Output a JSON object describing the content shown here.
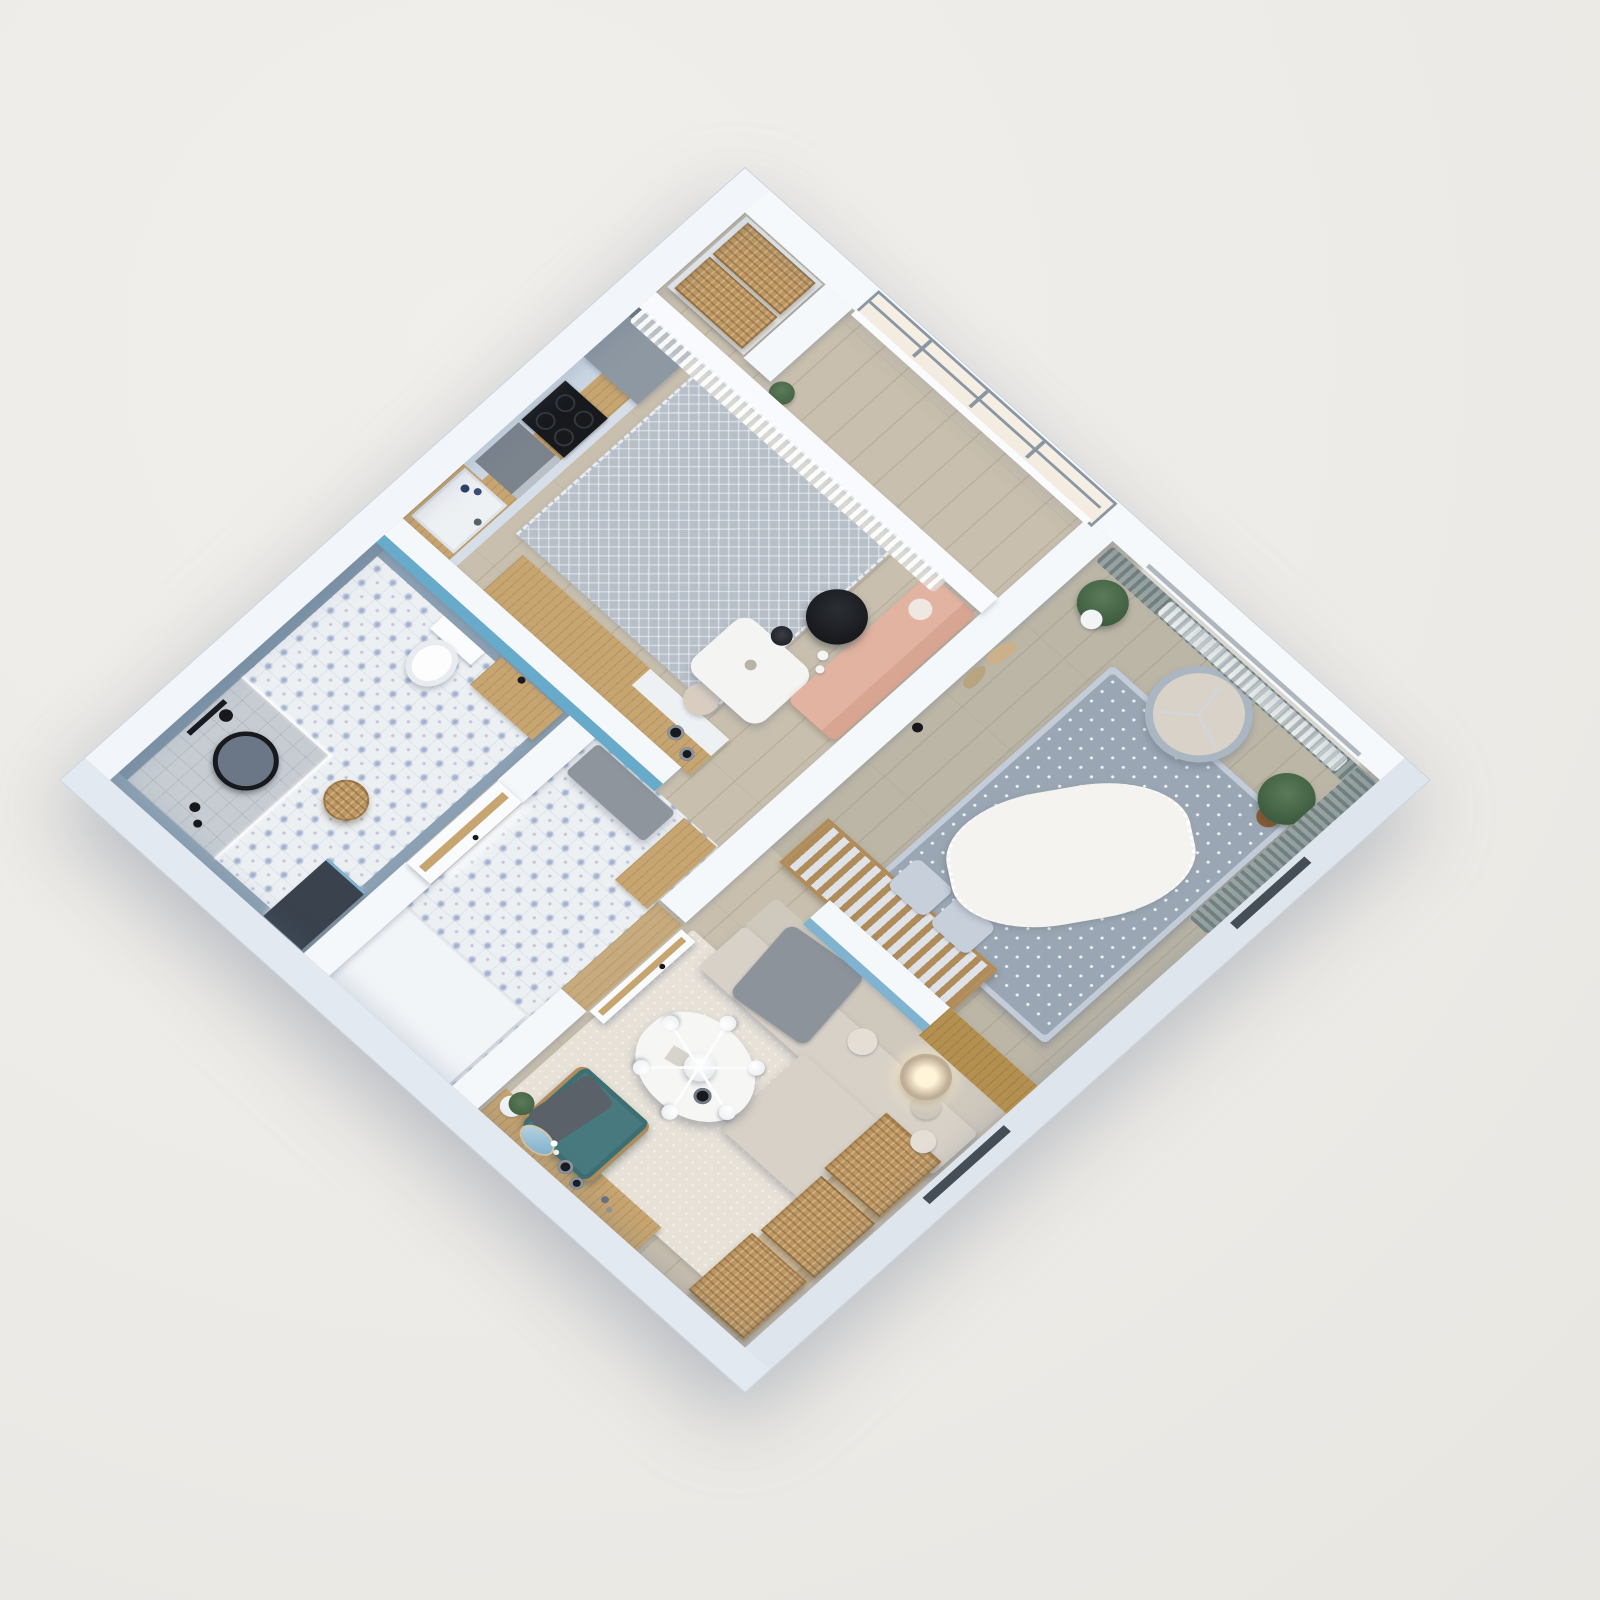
{
  "scene": {
    "type": "3d-isometric-floorplan-render",
    "label": "3D cutaway floor plan of a one-bedroom apartment",
    "view": "top-down isometric, plan rotated 45 degrees on a warm light-gray backdrop"
  },
  "palette": {
    "bg": "#edebe7",
    "wall": "#f5f8fb",
    "wallTop": "#f8fafd",
    "wallShade": "#dee5ed",
    "wallEdge": "#c9d1da",
    "wood": "#c7a571",
    "woodFloor": "#c8bfae",
    "bedroomTint": "rgba(120,125,125,.14)",
    "tileBase": "#edf0f3",
    "tileBlue": "#5d7ab0",
    "accentBlue": "#68aac9",
    "accentBlueSoft": "#7fb3cf",
    "teal": "#47797e",
    "tealDark": "#3d6e72",
    "peach": "#e2b3a1",
    "peachDark": "#d8a592",
    "sofaBeige": "#d8d1c7",
    "sofaBeigeDark": "#cfc8bd",
    "bedding": "#9aa6b3",
    "bedFrame": "#c2cdd9",
    "pillow": "#c6cfda",
    "blanket": "#f4f3f0",
    "curtain": "#98a5a4",
    "curtainDark": "#75817e",
    "wicker": "#bd9662",
    "rugKitchen": "#b7bfc9",
    "rugLiving": "#e7e1d7",
    "black": "#17191d",
    "glass": "#f3ebdf",
    "frame": "#8b96a3",
    "fridge": "#8e98a3",
    "oven": "#7b838d",
    "grayThrow": "#8d939b",
    "benchGray": "#8f959d",
    "shower": "#c6ccd2",
    "bathWall": "#8ba1b3",
    "mirrorDark": "#39424d",
    "potBrown": "#8a5a33",
    "plant": "#3d5c3f",
    "plantLight": "#5a7a58",
    "lampShade": "#bfae97",
    "glow": "#fff3d8",
    "cribWood": "#b08c5a",
    "headboard": "#b3904f",
    "cabinetBlue": "#cdd8e4",
    "white": "#ffffff"
  },
  "rooms": {
    "balcony": {
      "label": "Balcony niche with storage and window",
      "items": [
        "built-in cabinet",
        "wicker basket",
        "wicker basket",
        "window",
        "sheer curtain",
        "potted plant"
      ]
    },
    "kitchen_dining": {
      "label": "Kitchen and dining area",
      "items": [
        "fridge",
        "induction cooktop",
        "oven",
        "sink with bottles",
        "base cabinets",
        "upper cabinets",
        "peninsula counter",
        "storage jars",
        "patterned rug",
        "dining table",
        "chair",
        "peach loveseat",
        "black side table",
        "black table lamp",
        "vases"
      ]
    },
    "hallway": {
      "label": "Hallway with blue accent wall",
      "items": [
        "blue accent wall",
        "upholstered bench",
        "wardrobe",
        "patterned tile floor",
        "built-in closet",
        "LED light strip"
      ]
    },
    "bathroom": {
      "label": "Bathroom with walk-in shower",
      "items": [
        "walk-in shower",
        "glass partition",
        "black round mirror",
        "shower column",
        "toilet",
        "wood shelf",
        "round wicker basket",
        "leaning LED mirror",
        "patterned tile floor",
        "bottles"
      ]
    },
    "bedroom": {
      "label": "Bedroom with crib",
      "items": [
        "double bed",
        "polka-dot duvet",
        "fringed white throw",
        "pillows",
        "baby crib",
        "gray curtains",
        "sheer curtain",
        "leaning round mirror",
        "monstera on plant stand",
        "fiddle-leaf fig",
        "pampas wall decor",
        "wall sconce"
      ]
    },
    "living_room": {
      "label": "Living room",
      "items": [
        "corner sofa",
        "cushions",
        "gray throw",
        "coffee table",
        "sputnik chandelier",
        "table decor",
        "teal armchair",
        "wicker chest",
        "wicker chest",
        "wicker chest",
        "floor lamp",
        "area rug",
        "wood sideboard",
        "decorative plates",
        "mirror tray",
        "potted succulent",
        "open interior door"
      ]
    }
  },
  "architecture": {
    "walls": [
      "exterior shell",
      "balcony niche stub",
      "kitchen-bedroom divider",
      "blue hallway wall",
      "bedroom-living partition with wood headboard cladding",
      "bathroom wall"
    ],
    "doors": [
      "bathroom door",
      "living room door (open)"
    ],
    "windows": [
      "balcony window",
      "bedroom window behind curtains",
      "facade window slit upper",
      "facade window slit lower"
    ]
  }
}
